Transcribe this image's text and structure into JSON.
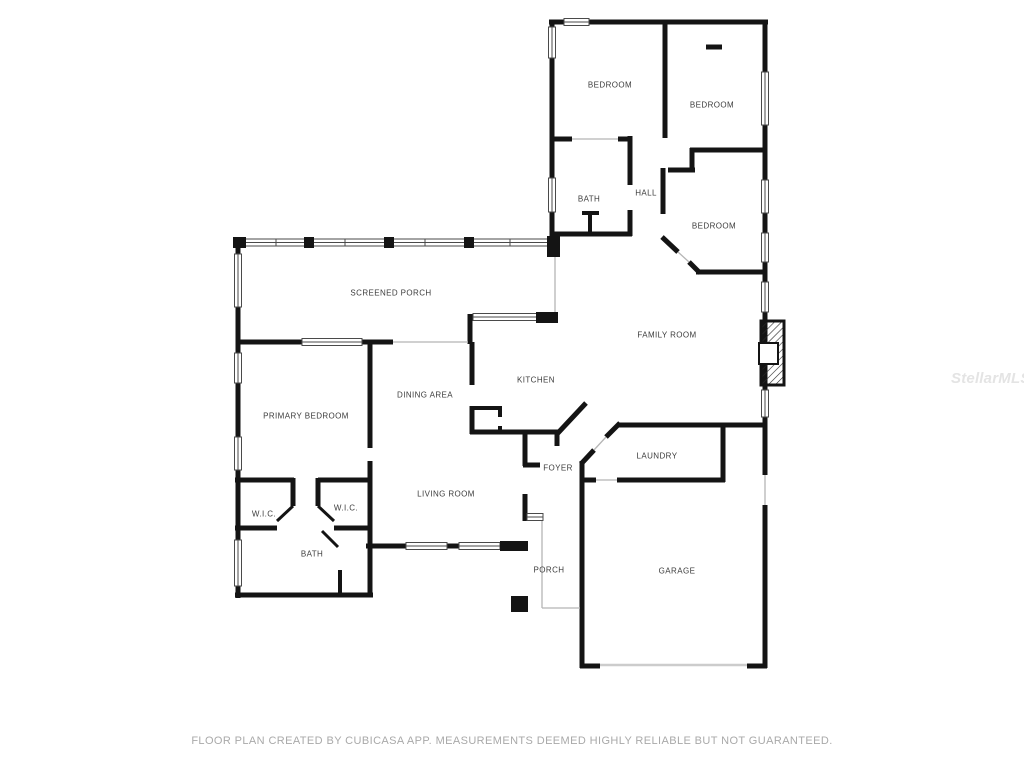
{
  "page": {
    "background": "#ffffff",
    "footer": "FLOOR PLAN CREATED BY CUBICASA APP. MEASUREMENTS DEEMED HIGHLY RELIABLE BUT NOT GUARANTEED.",
    "watermark": "StellarMLS"
  },
  "colors": {
    "wall": "#141414",
    "window_stroke": "#4a4a4a",
    "door_opening": "#b5b5b5",
    "garage_door": "#cccccc",
    "room_label": "#3c3c3c",
    "footer_text": "#a9a9a9",
    "watermark_text": "#e4e4e4",
    "background": "#ffffff"
  },
  "floorplan": {
    "rooms": [
      {
        "id": "bedroom-1",
        "label": "BEDROOM",
        "x": 610,
        "y": 85
      },
      {
        "id": "bedroom-2",
        "label": "BEDROOM",
        "x": 712,
        "y": 105
      },
      {
        "id": "bath-hall",
        "label": "BATH",
        "x": 589,
        "y": 199
      },
      {
        "id": "hall",
        "label": "HALL",
        "x": 646,
        "y": 193
      },
      {
        "id": "bedroom-3",
        "label": "BEDROOM",
        "x": 714,
        "y": 226
      },
      {
        "id": "screened-porch",
        "label": "SCREENED PORCH",
        "x": 391,
        "y": 293
      },
      {
        "id": "family-room",
        "label": "FAMILY ROOM",
        "x": 667,
        "y": 335
      },
      {
        "id": "kitchen",
        "label": "KITCHEN",
        "x": 536,
        "y": 380
      },
      {
        "id": "dining-area",
        "label": "DINING AREA",
        "x": 425,
        "y": 395
      },
      {
        "id": "primary-bedroom",
        "label": "PRIMARY BEDROOM",
        "x": 306,
        "y": 416
      },
      {
        "id": "laundry",
        "label": "LAUNDRY",
        "x": 657,
        "y": 456
      },
      {
        "id": "foyer",
        "label": "FOYER",
        "x": 558,
        "y": 468
      },
      {
        "id": "living-room",
        "label": "LIVING ROOM",
        "x": 446,
        "y": 494
      },
      {
        "id": "wic-left",
        "label": "W.I.C.",
        "x": 264,
        "y": 514
      },
      {
        "id": "wic-right",
        "label": "W.I.C.",
        "x": 346,
        "y": 508
      },
      {
        "id": "bath-primary",
        "label": "BATH",
        "x": 312,
        "y": 554
      },
      {
        "id": "porch",
        "label": "PORCH",
        "x": 549,
        "y": 570
      },
      {
        "id": "garage",
        "label": "GARAGE",
        "x": 677,
        "y": 571
      }
    ]
  }
}
